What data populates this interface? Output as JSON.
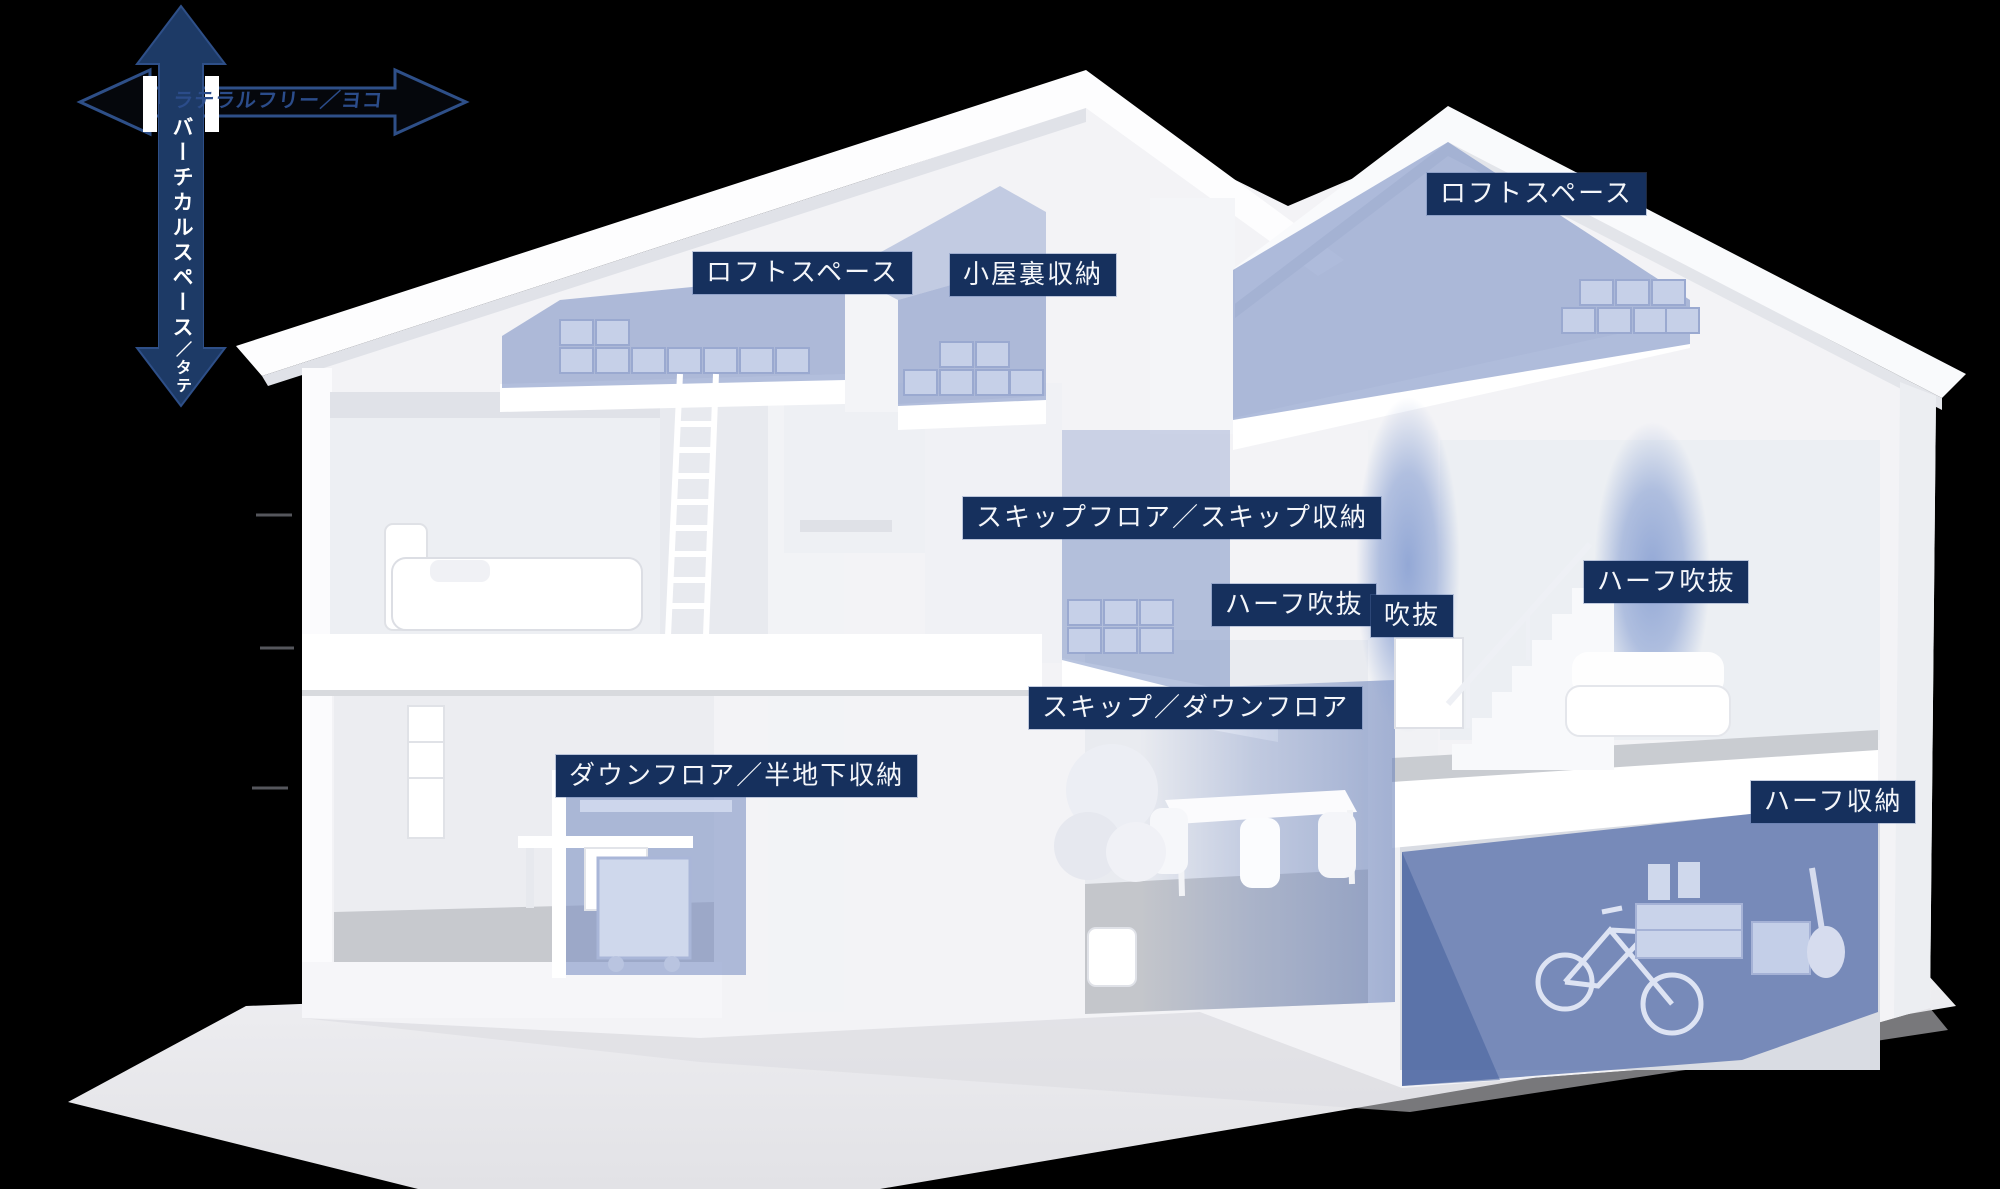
{
  "scene": {
    "background": "#000000"
  },
  "axis_arrows": {
    "vertical": {
      "label_main": "バーチカルスペース",
      "label_sub": "／タテ",
      "direction": "up-down"
    },
    "horizontal": {
      "label": "ラテラルフリー／ヨコ",
      "direction": "left-right"
    }
  },
  "room_labels": [
    {
      "id": "loft-left",
      "text": "ロフトスペース"
    },
    {
      "id": "attic-storage",
      "text": "小屋裏収納"
    },
    {
      "id": "loft-right",
      "text": "ロフトスペース"
    },
    {
      "id": "skip-floor",
      "text": "スキップフロア／スキップ収納"
    },
    {
      "id": "half-void-left",
      "text": "ハーフ吹抜"
    },
    {
      "id": "void",
      "text": "吹抜"
    },
    {
      "id": "half-void-right",
      "text": "ハーフ吹抜"
    },
    {
      "id": "skip-down-floor",
      "text": "スキップ／ダウンフロア"
    },
    {
      "id": "down-floor",
      "text": "ダウンフロア／半地下収納"
    },
    {
      "id": "half-storage",
      "text": "ハーフ収納"
    }
  ],
  "colors": {
    "badge-bg": "#16305d",
    "badge-text": "#f4f6fa",
    "arrow-navy": "#1d3a66",
    "axis-h-text": "#2b4c8a",
    "highlight-blue": "#7e93c5",
    "house-white": "#f5f5f7",
    "ground": "#ebebee"
  }
}
